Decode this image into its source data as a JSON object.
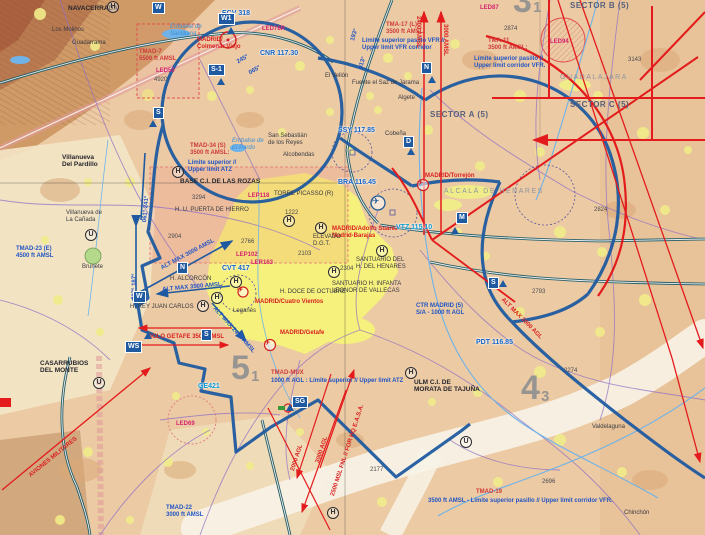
{
  "colors": {
    "terrain": "#eccaa4",
    "mountain": "#cf9a66",
    "mountain2": "#b97a50",
    "mountain3": "#a9613f",
    "cream": "#f3e6c6",
    "valley": "#f8f3e8",
    "urban": "#f1ec8a",
    "madrid": "#f6f07c",
    "ctr": "#1f5aa0",
    "red": "#e31b1c",
    "red2": "#d92020",
    "tma": "#cf3b3b",
    "mag": "#d6246e",
    "freq": "#1464c8",
    "cyan": "#0a9bd6",
    "purple": "#8f6fc5",
    "teal": "#2c6068",
    "river": "#6fb3e8",
    "pink": "#e09a9a"
  },
  "labels": [
    {
      "n": "label-navacerrada",
      "c": "darkb",
      "x": 68,
      "y": 5,
      "t": "NAVACERRADA"
    },
    {
      "n": "label-los-molinos",
      "c": "dark",
      "x": 52,
      "y": 27,
      "t": "Los Molinos"
    },
    {
      "n": "label-guadarrama",
      "c": "dark",
      "x": 72,
      "y": 40,
      "t": "Guadarrama"
    },
    {
      "n": "label-embalse-santillana",
      "c": "water",
      "x": 170,
      "y": 24,
      "t": "Embalse de\nSantillana"
    },
    {
      "n": "label-ecv-freq",
      "c": "freq",
      "x": 222,
      "y": 10,
      "t": "ECV 318"
    },
    {
      "n": "label-led78r",
      "c": "mag",
      "x": 262,
      "y": 26,
      "t": "LED78R"
    },
    {
      "n": "label-colmenar-viejo",
      "c": "redt",
      "x": 197,
      "y": 37,
      "t": "MADRID/\nColmenar Viejo"
    },
    {
      "n": "label-cnr-freq",
      "c": "freq",
      "x": 260,
      "y": 50,
      "t": "CNR 117.30"
    },
    {
      "n": "label-tmad7",
      "c": "tma",
      "x": 139,
      "y": 49,
      "t": "TMAD-7\n5500 ft AMSL"
    },
    {
      "n": "label-led50",
      "c": "mag",
      "x": 156,
      "y": 68,
      "t": "LED50"
    },
    {
      "n": "label-elev-4920",
      "c": "elev",
      "x": 154,
      "y": 77,
      "t": "4920"
    },
    {
      "n": "label-tma17",
      "c": "tma",
      "x": 386,
      "y": 22,
      "t": "TMA-17 (L)\n3500 ft AMSL:"
    },
    {
      "n": "label-tma17-limits",
      "c": "binfo",
      "x": 362,
      "y": 38,
      "t": "Límite superior pasillo VFR //\nUpper limit VFR corridor"
    },
    {
      "n": "label-2400-amsl",
      "c": "redrot",
      "x": 421,
      "y": 16,
      "r": 90,
      "t": "2400 AMSL"
    },
    {
      "n": "label-3000-amsl",
      "c": "redrot",
      "x": 448,
      "y": 24,
      "r": 90,
      "t": "3000 AMSL"
    },
    {
      "n": "label-el-vellon",
      "c": "dark",
      "x": 325,
      "y": 73,
      "t": "El Vellón"
    },
    {
      "n": "label-sector-b",
      "c": "sector",
      "x": 570,
      "y": 2,
      "t": "SECTOR B (5)"
    },
    {
      "n": "label-led87",
      "c": "mag",
      "x": 480,
      "y": 5,
      "t": "LED87"
    },
    {
      "n": "label-tma11",
      "c": "tma",
      "x": 488,
      "y": 38,
      "t": "TMA-11\n3500 ft AMSL:"
    },
    {
      "n": "label-tma11-limits",
      "c": "binfo",
      "x": 474,
      "y": 56,
      "t": "Límite superior pasillo //\nUpper limit corridor VFR."
    },
    {
      "n": "label-elev-2874",
      "c": "elev",
      "x": 504,
      "y": 26,
      "t": "2874"
    },
    {
      "n": "label-elev-3143",
      "c": "elev",
      "x": 628,
      "y": 57,
      "t": "3143"
    },
    {
      "n": "label-guadalajara",
      "c": "faint",
      "x": 560,
      "y": 74,
      "t": "GUADALAJARA"
    },
    {
      "n": "label-sector-c",
      "c": "sector",
      "x": 570,
      "y": 101,
      "t": "SECTOR C (5)"
    },
    {
      "n": "label-sector-a",
      "c": "sector",
      "x": 430,
      "y": 111,
      "t": "SECTOR A (5)"
    },
    {
      "n": "label-ssy-freq",
      "c": "freq",
      "x": 338,
      "y": 127,
      "t": "SSY 117.85"
    },
    {
      "n": "label-led94",
      "c": "mag",
      "x": 550,
      "y": 39,
      "t": "LED94"
    },
    {
      "n": "label-san-sebastian",
      "c": "dark",
      "x": 268,
      "y": 133,
      "t": "San Sebastián\nde los Reyes"
    },
    {
      "n": "label-alcobendas",
      "c": "dark",
      "x": 283,
      "y": 152,
      "t": "Alcobendas"
    },
    {
      "n": "label-fuente-saz",
      "c": "dark",
      "x": 352,
      "y": 80,
      "t": "Fuente el Saz de Jarama"
    },
    {
      "n": "label-algete",
      "c": "dark",
      "x": 398,
      "y": 95,
      "t": "Algete"
    },
    {
      "n": "label-cobena",
      "c": "dark",
      "x": 385,
      "y": 131,
      "t": "Cobeña"
    },
    {
      "n": "label-torrejon",
      "c": "redt",
      "x": 425,
      "y": 173,
      "t": "MADRID/Torrejón"
    },
    {
      "n": "label-alcala",
      "c": "faint",
      "x": 444,
      "y": 188,
      "t": "ALCALÁ DE HENARES"
    },
    {
      "n": "label-bra-freq",
      "c": "freq",
      "x": 338,
      "y": 179,
      "t": "BRA 116.45"
    },
    {
      "n": "label-barajas",
      "c": "redt",
      "x": 332,
      "y": 226,
      "t": "MADRID/Adolfo Suárez\nMadrid-Barajas"
    },
    {
      "n": "label-torre-picasso",
      "c": "dark",
      "x": 274,
      "y": 191,
      "t": "TORRE PICASSO (R)"
    },
    {
      "n": "label-elev-1222",
      "c": "elev",
      "x": 285,
      "y": 210,
      "t": "1222"
    },
    {
      "n": "label-elevado-dgt",
      "c": "dark",
      "x": 313,
      "y": 234,
      "t": "ELEVADO\nD.G.T."
    },
    {
      "n": "label-vtz-freq",
      "c": "cyan",
      "x": 396,
      "y": 224,
      "t": "VTZ 115.10"
    },
    {
      "n": "label-santuario-henares",
      "c": "dark",
      "x": 356,
      "y": 257,
      "t": "SANTUARIO DEL\nH. DEL HENARES"
    },
    {
      "n": "label-santuario-vallecas",
      "c": "dark",
      "x": 332,
      "y": 281,
      "t": "SANTUARIO H. INFANTA\nLEONOR DE VALLECAS"
    },
    {
      "n": "label-doce-octubre",
      "c": "dark",
      "x": 280,
      "y": 289,
      "t": "H. DOCE DE OCTUBRE"
    },
    {
      "n": "label-cuatro-vientos",
      "c": "redt",
      "x": 255,
      "y": 299,
      "t": "MADRID/Cuatro Vientos"
    },
    {
      "n": "label-leganes",
      "c": "dark",
      "x": 233,
      "y": 308,
      "t": "Leganés"
    },
    {
      "n": "label-getafe",
      "c": "redt",
      "x": 280,
      "y": 330,
      "t": "MADRID/Getafe"
    },
    {
      "n": "label-ctr-madrid",
      "c": "binfo",
      "x": 416,
      "y": 303,
      "t": "CTR MADRID (5)\nS/A - 1000 ft AGL"
    },
    {
      "n": "label-lep102",
      "c": "mag",
      "x": 236,
      "y": 252,
      "t": "LEP102"
    },
    {
      "n": "label-ler163",
      "c": "mag",
      "x": 251,
      "y": 260,
      "t": "LER163"
    },
    {
      "n": "label-cvt-freq",
      "c": "freq",
      "x": 222,
      "y": 265,
      "t": "CVT 417"
    },
    {
      "n": "label-tmad34",
      "c": "tma",
      "x": 190,
      "y": 143,
      "t": "TMAD-34 (S)\n3500 ft AMSL:"
    },
    {
      "n": "label-tmad34-limits",
      "c": "binfo",
      "x": 188,
      "y": 160,
      "t": "Límite superior //\nUpper limit ATZ"
    },
    {
      "n": "label-base-rozas",
      "c": "darkb",
      "x": 180,
      "y": 178,
      "t": "BASE C.I. DE LAS ROZAS"
    },
    {
      "n": "label-elev-3294",
      "c": "elev",
      "x": 192,
      "y": 195,
      "t": "3294"
    },
    {
      "n": "label-lep118",
      "c": "mag",
      "x": 248,
      "y": 193,
      "t": "LEP118"
    },
    {
      "n": "label-puerta-hierro",
      "c": "dark",
      "x": 175,
      "y": 207,
      "t": "H. U. PUERTA DE HIERRO"
    },
    {
      "n": "label-elev-2904",
      "c": "elev",
      "x": 168,
      "y": 234,
      "t": "2904"
    },
    {
      "n": "label-elev-2766",
      "c": "elev",
      "x": 241,
      "y": 239,
      "t": "2766"
    },
    {
      "n": "label-elev-2103",
      "c": "elev",
      "x": 298,
      "y": 251,
      "t": "2103"
    },
    {
      "n": "label-elev-2304",
      "c": "elev",
      "x": 340,
      "y": 266,
      "t": "2304"
    },
    {
      "n": "label-alt-max-3000",
      "c": "balt",
      "x": 160,
      "y": 266,
      "r": -28,
      "t": "ALT MAX 3000 AMSL"
    },
    {
      "n": "label-h-alcorcon",
      "c": "dark",
      "x": 170,
      "y": 276,
      "t": "H. ALCORCÓN"
    },
    {
      "n": "label-alt-max-3500",
      "c": "balt",
      "x": 162,
      "y": 287,
      "r": -5,
      "t": "ALT MAX 3500 AMSL"
    },
    {
      "n": "label-rey-juan-carlos",
      "c": "dark",
      "x": 130,
      "y": 304,
      "t": "H. REY JUAN CARLOS"
    },
    {
      "n": "label-solo-getafe",
      "c": "redt",
      "x": 148,
      "y": 334,
      "t": "SOLO GETAFE 3500 AMSL"
    },
    {
      "n": "label-alt-max-2400",
      "c": "balt",
      "x": 216,
      "y": 306,
      "r": 48,
      "t": "ALT MAX 2400 AMSL"
    },
    {
      "n": "label-brg-007-187",
      "c": "balt",
      "x": 132,
      "y": 300,
      "r": -90,
      "t": "007° 187°"
    },
    {
      "n": "label-brg-061-241",
      "c": "balt",
      "x": 142,
      "y": 222,
      "r": -85,
      "t": "061° 241°"
    },
    {
      "n": "label-brg-245",
      "c": "balt",
      "x": 236,
      "y": 60,
      "r": -30,
      "t": "245°"
    },
    {
      "n": "label-brg-065",
      "c": "balt",
      "x": 248,
      "y": 71,
      "r": -30,
      "t": "065°"
    },
    {
      "n": "label-brg-193",
      "c": "balt",
      "x": 350,
      "y": 40,
      "r": -73,
      "t": "193°"
    },
    {
      "n": "label-brg-013",
      "c": "balt",
      "x": 358,
      "y": 68,
      "r": -73,
      "t": "013°"
    },
    {
      "n": "label-vva-pardillo",
      "c": "darkb",
      "x": 62,
      "y": 154,
      "t": "Villanueva\nDel Pardillo"
    },
    {
      "n": "label-vva-canada",
      "c": "dark",
      "x": 66,
      "y": 210,
      "t": "Villanueva de\nLa Cañada"
    },
    {
      "n": "label-tmad23",
      "c": "binfo",
      "x": 16,
      "y": 246,
      "t": "TMAD-23 (E)\n4500 ft AMSL"
    },
    {
      "n": "label-brunete",
      "c": "dark",
      "x": 82,
      "y": 264,
      "t": "Brunete"
    },
    {
      "n": "label-embalse-pardo",
      "c": "water",
      "x": 232,
      "y": 138,
      "t": "Embalse de\nEl Pardo"
    },
    {
      "n": "label-casarrubios",
      "c": "darkb",
      "x": 40,
      "y": 360,
      "t": "CASARRUBIOS\nDEL MONTE"
    },
    {
      "n": "label-ge421",
      "c": "cyan",
      "x": 198,
      "y": 383,
      "t": "GE421"
    },
    {
      "n": "label-led69",
      "c": "mag",
      "x": 176,
      "y": 421,
      "t": "LED69"
    },
    {
      "n": "label-aviones-militares",
      "c": "redrot",
      "x": 28,
      "y": 474,
      "r": -39,
      "t": "AVIONES MILITARES"
    },
    {
      "n": "label-tmad22",
      "c": "binfo",
      "x": 166,
      "y": 505,
      "t": "TMAD-22\n3000 ft AMSL"
    },
    {
      "n": "label-tmad-mux",
      "c": "tma",
      "x": 271,
      "y": 370,
      "t": "TMAD-MUX"
    },
    {
      "n": "label-tmad-mux-limits",
      "c": "binfo",
      "x": 271,
      "y": 378,
      "t": "1000 ft AGL : Límite superior // Upper limit ATZ"
    },
    {
      "n": "label-ulm-morata",
      "c": "darkb",
      "x": 414,
      "y": 379,
      "t": "ULM C.I. DE\nMORATA DE TAJUÑA"
    },
    {
      "n": "label-elev-2274",
      "c": "elev",
      "x": 564,
      "y": 368,
      "t": "2274"
    },
    {
      "n": "label-elev-2824",
      "c": "elev",
      "x": 594,
      "y": 207,
      "t": "2824"
    },
    {
      "n": "label-elev-2793",
      "c": "elev",
      "x": 532,
      "y": 289,
      "t": "2793"
    },
    {
      "n": "label-2000-agl",
      "c": "redrot",
      "x": 290,
      "y": 470,
      "r": -72,
      "t": "2000 AGL"
    },
    {
      "n": "label-3000-agl",
      "c": "redrot",
      "x": 315,
      "y": 462,
      "r": -72,
      "t": "3000 AGL"
    },
    {
      "n": "label-2500-msl",
      "c": "redrot",
      "x": 330,
      "y": 495,
      "r": -72,
      "t": "2500 MSL FNL // FOR HQ E.A.S.A."
    },
    {
      "n": "label-alt-max-1000",
      "c": "redrot",
      "x": 504,
      "y": 297,
      "r": 45,
      "t": "ALT MAX 1000 AGL"
    },
    {
      "n": "label-pdt-freq",
      "c": "freq",
      "x": 476,
      "y": 339,
      "t": "PDT 116.85"
    },
    {
      "n": "label-elev-2177",
      "c": "elev",
      "x": 370,
      "y": 467,
      "t": "2177"
    },
    {
      "n": "label-elev-2696",
      "c": "elev",
      "x": 542,
      "y": 479,
      "t": "2696"
    },
    {
      "n": "label-valdelaguna",
      "c": "dark",
      "x": 592,
      "y": 424,
      "t": "Valdelaguna"
    },
    {
      "n": "label-chinchon",
      "c": "dark",
      "x": 624,
      "y": 510,
      "t": "Chinchón"
    },
    {
      "n": "label-tmad19",
      "c": "tma",
      "x": 476,
      "y": 489,
      "t": "TMAD-19"
    },
    {
      "n": "label-tmad19-limits",
      "c": "binfo",
      "x": 428,
      "y": 498,
      "t": "3500 ft AMSL - Límite superior pasillo // Upper limit corridor VFR."
    },
    {
      "n": "point-box-w-top",
      "c": "pbox",
      "x": 152,
      "y": 2,
      "t": "W"
    },
    {
      "n": "point-box-w1",
      "c": "pbox",
      "x": 218,
      "y": 13,
      "t": "W1"
    },
    {
      "n": "point-box-s1",
      "c": "pbox",
      "x": 208,
      "y": 64,
      "t": "S-1"
    },
    {
      "n": "point-box-s-west",
      "c": "pbox",
      "x": 153,
      "y": 107,
      "t": "S"
    },
    {
      "n": "point-box-n-top",
      "c": "pbox",
      "x": 421,
      "y": 62,
      "t": "N"
    },
    {
      "n": "point-box-d",
      "c": "pbox",
      "x": 403,
      "y": 136,
      "t": "D"
    },
    {
      "n": "point-box-m",
      "c": "pbox",
      "x": 456,
      "y": 212,
      "t": "M"
    },
    {
      "n": "point-box-n-alcorcon",
      "c": "pbox",
      "x": 177,
      "y": 262,
      "t": "N"
    },
    {
      "n": "point-box-w-alcorcon",
      "c": "pbox",
      "x": 133,
      "y": 291,
      "t": "W"
    },
    {
      "n": "point-box-s-getafe",
      "c": "pbox",
      "x": 201,
      "y": 329,
      "t": "S"
    },
    {
      "n": "point-box-ws",
      "c": "pbox",
      "x": 125,
      "y": 341,
      "t": "WS"
    },
    {
      "n": "point-box-s-east",
      "c": "pbox",
      "x": 488,
      "y": 277,
      "t": "S"
    },
    {
      "n": "point-box-sg",
      "c": "pbox",
      "x": 292,
      "y": 396,
      "t": "SG"
    },
    {
      "n": "vfr-point-triangle",
      "c": "tri",
      "x": 227,
      "y": 27,
      "t": ""
    },
    {
      "n": "vfr-point-triangle",
      "c": "tri",
      "x": 217,
      "y": 78,
      "t": ""
    },
    {
      "n": "vfr-point-triangle",
      "c": "tri",
      "x": 149,
      "y": 120,
      "t": ""
    },
    {
      "n": "vfr-point-triangle",
      "c": "tri",
      "x": 428,
      "y": 76,
      "t": ""
    },
    {
      "n": "vfr-point-triangle",
      "c": "tri",
      "x": 407,
      "y": 148,
      "t": ""
    },
    {
      "n": "vfr-point-triangle",
      "c": "tri",
      "x": 451,
      "y": 227,
      "t": ""
    },
    {
      "n": "vfr-point-triangle",
      "c": "tri",
      "x": 499,
      "y": 280,
      "t": ""
    },
    {
      "n": "vfr-point-triangle",
      "c": "tri",
      "x": 144,
      "y": 332,
      "t": ""
    },
    {
      "n": "vfr-point-triangle",
      "c": "tri",
      "x": 286,
      "y": 404,
      "t": ""
    },
    {
      "n": "heliport-marker",
      "c": "hc",
      "x": 107,
      "y": 1,
      "t": "H"
    },
    {
      "n": "heliport-marker",
      "c": "hc",
      "x": 172,
      "y": 166,
      "t": "H"
    },
    {
      "n": "heliport-marker",
      "c": "hc",
      "x": 283,
      "y": 215,
      "t": "H"
    },
    {
      "n": "heliport-marker",
      "c": "hc",
      "x": 315,
      "y": 222,
      "t": "H"
    },
    {
      "n": "heliport-marker",
      "c": "hc",
      "x": 328,
      "y": 266,
      "t": "H"
    },
    {
      "n": "heliport-marker",
      "c": "hc",
      "x": 376,
      "y": 245,
      "t": "H"
    },
    {
      "n": "heliport-marker",
      "c": "hc",
      "x": 197,
      "y": 300,
      "t": "H"
    },
    {
      "n": "heliport-marker",
      "c": "hc",
      "x": 211,
      "y": 292,
      "t": "H"
    },
    {
      "n": "heliport-marker",
      "c": "hc",
      "x": 230,
      "y": 276,
      "t": "H"
    },
    {
      "n": "heliport-marker",
      "c": "hc",
      "x": 405,
      "y": 367,
      "t": "H"
    },
    {
      "n": "heliport-marker",
      "c": "hc",
      "x": 327,
      "y": 507,
      "t": "H"
    },
    {
      "n": "ulm-marker",
      "c": "uc",
      "x": 85,
      "y": 229,
      "t": "U"
    },
    {
      "n": "ulm-marker",
      "c": "uc",
      "x": 93,
      "y": 377,
      "t": "U"
    },
    {
      "n": "ulm-marker",
      "c": "uc",
      "x": 460,
      "y": 436,
      "t": "U"
    },
    {
      "n": "chart-number-5",
      "c": "num",
      "x": 231,
      "y": 349,
      "t": "5"
    },
    {
      "n": "chart-number-5-sub",
      "c": "nsub",
      "x": 251,
      "y": 369,
      "t": "1"
    },
    {
      "n": "chart-number-4",
      "c": "num",
      "x": 521,
      "y": 369,
      "t": "4"
    },
    {
      "n": "chart-number-4-sub",
      "c": "nsub",
      "x": 541,
      "y": 389,
      "t": "3"
    },
    {
      "n": "chart-number-3",
      "c": "num",
      "x": 513,
      "y": -18,
      "t": "3"
    },
    {
      "n": "chart-number-3-sub",
      "c": "nsub",
      "x": 533,
      "y": 0,
      "t": "1"
    },
    {
      "n": "airport-icon-barajas",
      "c": "plb",
      "x": 372,
      "y": 196,
      "t": "✈"
    },
    {
      "n": "airport-icon-torrejon",
      "c": "plr",
      "x": 417,
      "y": 179,
      "t": "✈"
    },
    {
      "n": "airport-icon-getafe",
      "c": "plr",
      "x": 264,
      "y": 339,
      "t": "✈"
    },
    {
      "n": "airport-icon-cuatro-vientos",
      "c": "plr",
      "x": 237,
      "y": 286,
      "t": "✈"
    }
  ]
}
